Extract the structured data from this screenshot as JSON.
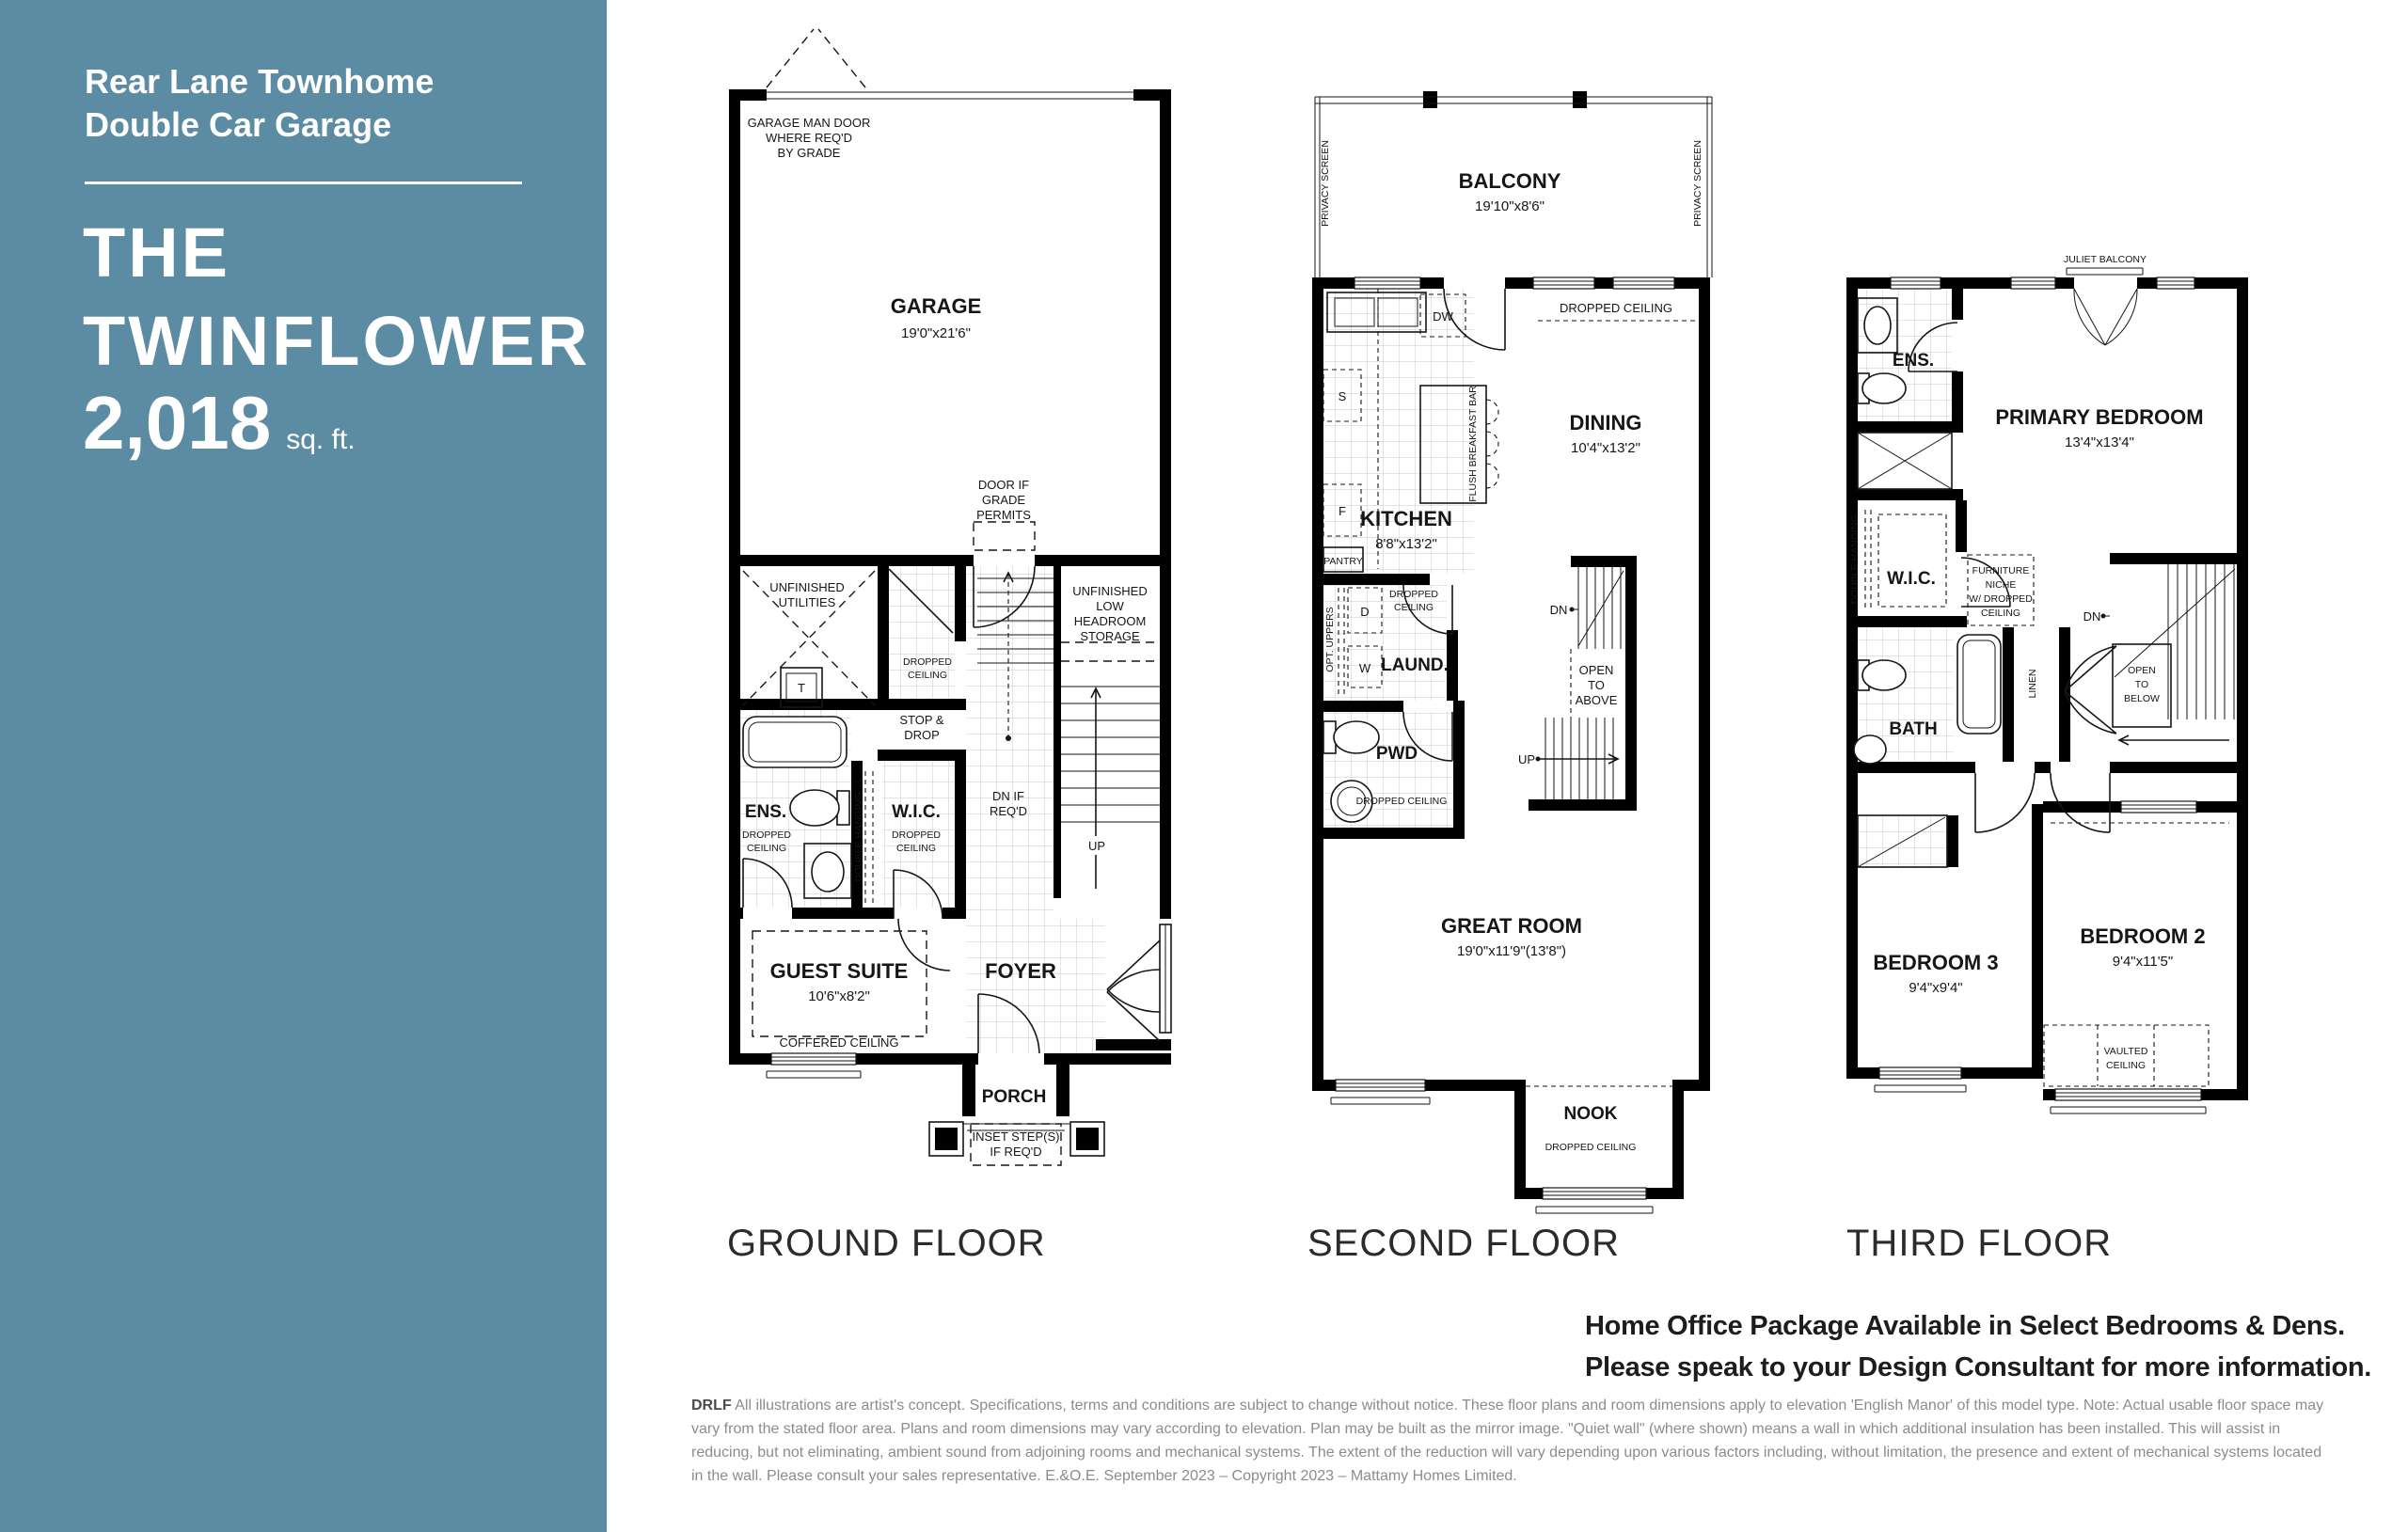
{
  "sidebar": {
    "bg_color": "#5c8ca4",
    "product_line": [
      "Rear Lane Townhome",
      "Double Car Garage"
    ],
    "model_name_line1": "THE",
    "model_name_line2": "TWINFLOWER",
    "sqft_value": "2,018",
    "sqft_unit": "sq. ft."
  },
  "common": {
    "dropped": "DROPPED",
    "ceiling": "CEILING",
    "dropped_ceiling": "DROPPED CEILING",
    "up": "UP",
    "dn": "DN"
  },
  "floors": {
    "ground": {
      "label": "GROUND FLOOR",
      "garage_man_door": [
        "GARAGE MAN DOOR",
        "WHERE REQ'D",
        "BY GRADE"
      ],
      "garage_name": "GARAGE",
      "garage_dims": "19'0\"x21'6\"",
      "door_if_grade": [
        "DOOR IF",
        "GRADE",
        "PERMITS"
      ],
      "unfinished_utilities": [
        "UNFINISHED",
        "UTILITIES"
      ],
      "tank": "T",
      "storage": [
        "UNFINISHED",
        "LOW",
        "HEADROOM",
        "STORAGE"
      ],
      "stop_drop": [
        "STOP &",
        "DROP"
      ],
      "dn_if_reqd": [
        "DN IF",
        "REQ'D"
      ],
      "ens_name": "ENS.",
      "double_hanging": "DOUBLE HANGING",
      "wic_name": "W.I.C.",
      "guest_name": "GUEST SUITE",
      "guest_dims": "10'6\"x8'2\"",
      "coffered": "COFFERED CEILING",
      "foyer": "FOYER",
      "porch": "PORCH",
      "inset_steps": [
        "INSET STEP(S)",
        "IF REQ'D"
      ]
    },
    "second": {
      "label": "SECOND FLOOR",
      "balcony_name": "BALCONY",
      "balcony_dims": "19'10\"x8'6\"",
      "privacy_screen": "PRIVACY SCREEN",
      "dw": "DW",
      "stove": "S",
      "fridge": "F",
      "pantry": "PANTRY",
      "breakfast_bar": "FLUSH BREAKFAST BAR",
      "kitchen_name": "KITCHEN",
      "kitchen_dims": "8'8\"x13'2\"",
      "dining_name": "DINING",
      "dining_dims": "10'4\"x13'2\"",
      "opt_uppers": "OPT. UPPERS",
      "dryer": "D",
      "washer": "W",
      "laundry_name": "LAUND.",
      "pwd_name": "PWD",
      "open_to_above": [
        "OPEN",
        "TO",
        "ABOVE"
      ],
      "great_name": "GREAT ROOM",
      "great_dims": "19'0\"x11'9\"(13'8\")",
      "nook_name": "NOOK"
    },
    "third": {
      "label": "THIRD FLOOR",
      "juliet": "JULIET BALCONY",
      "ens_name": "ENS.",
      "primary_name": "PRIMARY BEDROOM",
      "primary_dims": "13'4\"x13'4\"",
      "double_hanging": "DOUBLE HANGING",
      "wic_name": "W.I.C.",
      "furniture_niche": [
        "FURNITURE",
        "NICHE",
        "W/ DROPPED",
        "CEILING"
      ],
      "linen": "LINEN",
      "bath_name": "BATH",
      "open_to_below": [
        "OPEN",
        "TO",
        "BELOW"
      ],
      "bed3_name": "BEDROOM 3",
      "bed3_dims": "9'4\"x9'4\"",
      "bed2_name": "BEDROOM 2",
      "bed2_dims": "9'4\"x11'5\"",
      "vaulted": [
        "VAULTED",
        "CEILING"
      ]
    }
  },
  "footer": {
    "home_office_line1": "Home Office Package Available in Select Bedrooms & Dens.",
    "home_office_line2": "Please speak to your Design Consultant for more information.",
    "disclaimer_code": "DRLF",
    "disclaimer_text": "All illustrations are artist's concept. Specifications, terms and conditions are subject to change without notice. These floor plans and room dimensions apply to elevation 'English Manor' of this model type. Note: Actual usable floor space may vary from the stated floor area. Plans and room dimensions may vary according to elevation. Plan may be built as the mirror image. \"Quiet wall\" (where shown) means a wall in which additional insulation has been installed. This will assist in reducing, but not eliminating, ambient sound from adjoining rooms and mechanical systems. The extent of the reduction will vary depending upon various factors including, without limitation, the presence and extent of mechanical systems located in the wall. Please consult your sales representative. E.&O.E. September 2023 – Copyright 2023 – Mattamy Homes Limited."
  }
}
